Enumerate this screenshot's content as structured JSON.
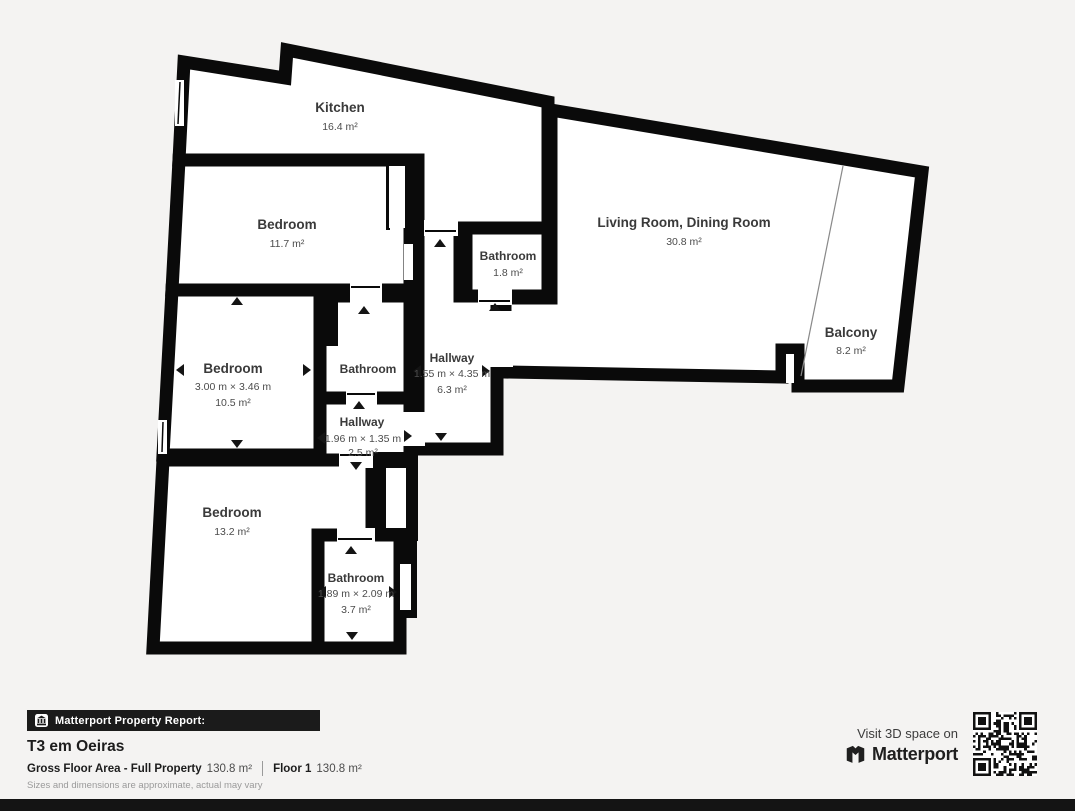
{
  "colors": {
    "background": "#f4f3f2",
    "walls": "#0a0a0a",
    "room_fill": "#ffffff",
    "badge_bg": "#1b1b1b",
    "footer_bar": "#141414"
  },
  "floorplan": {
    "rooms": {
      "kitchen": {
        "name": "Kitchen",
        "area": "16.4 m²"
      },
      "bedroom_top": {
        "name": "Bedroom",
        "area": "11.7 m²"
      },
      "bathroom_small": {
        "name": "Bathroom",
        "area": "1.8 m²"
      },
      "living_dining": {
        "name": "Living Room, Dining Room",
        "area": "30.8 m²"
      },
      "balcony": {
        "name": "Balcony",
        "area": "8.2 m²"
      },
      "bedroom_middle": {
        "name": "Bedroom",
        "dimensions": "3.00 m × 3.46 m",
        "area": "10.5 m²"
      },
      "bathroom_middle": {
        "name": "Bathroom"
      },
      "hallway_main": {
        "name": "Hallway",
        "dimensions": "1.55 m × 4.35 m",
        "area": "6.3 m²"
      },
      "hallway_small": {
        "name": "Hallway",
        "dimensions": "1.96 m × 1.35 m",
        "area": "2.5 m²"
      },
      "bedroom_bottom": {
        "name": "Bedroom",
        "area": "13.2 m²"
      },
      "bathroom_bottom": {
        "name": "Bathroom",
        "dimensions": "1.89 m × 2.09 m",
        "area": "3.7 m²"
      }
    }
  },
  "footer": {
    "badge_label": "Matterport Property Report:",
    "property_title": "T3 em Oeiras",
    "gross_floor_area_label": "Gross Floor Area - Full Property",
    "gross_floor_area_value": "130.8 m²",
    "floor_label": "Floor 1",
    "floor_value": "130.8 m²",
    "disclaimer": "Sizes and dimensions are approximate, actual may vary",
    "visit_text": "Visit 3D space on",
    "brand_name": "Matterport"
  }
}
